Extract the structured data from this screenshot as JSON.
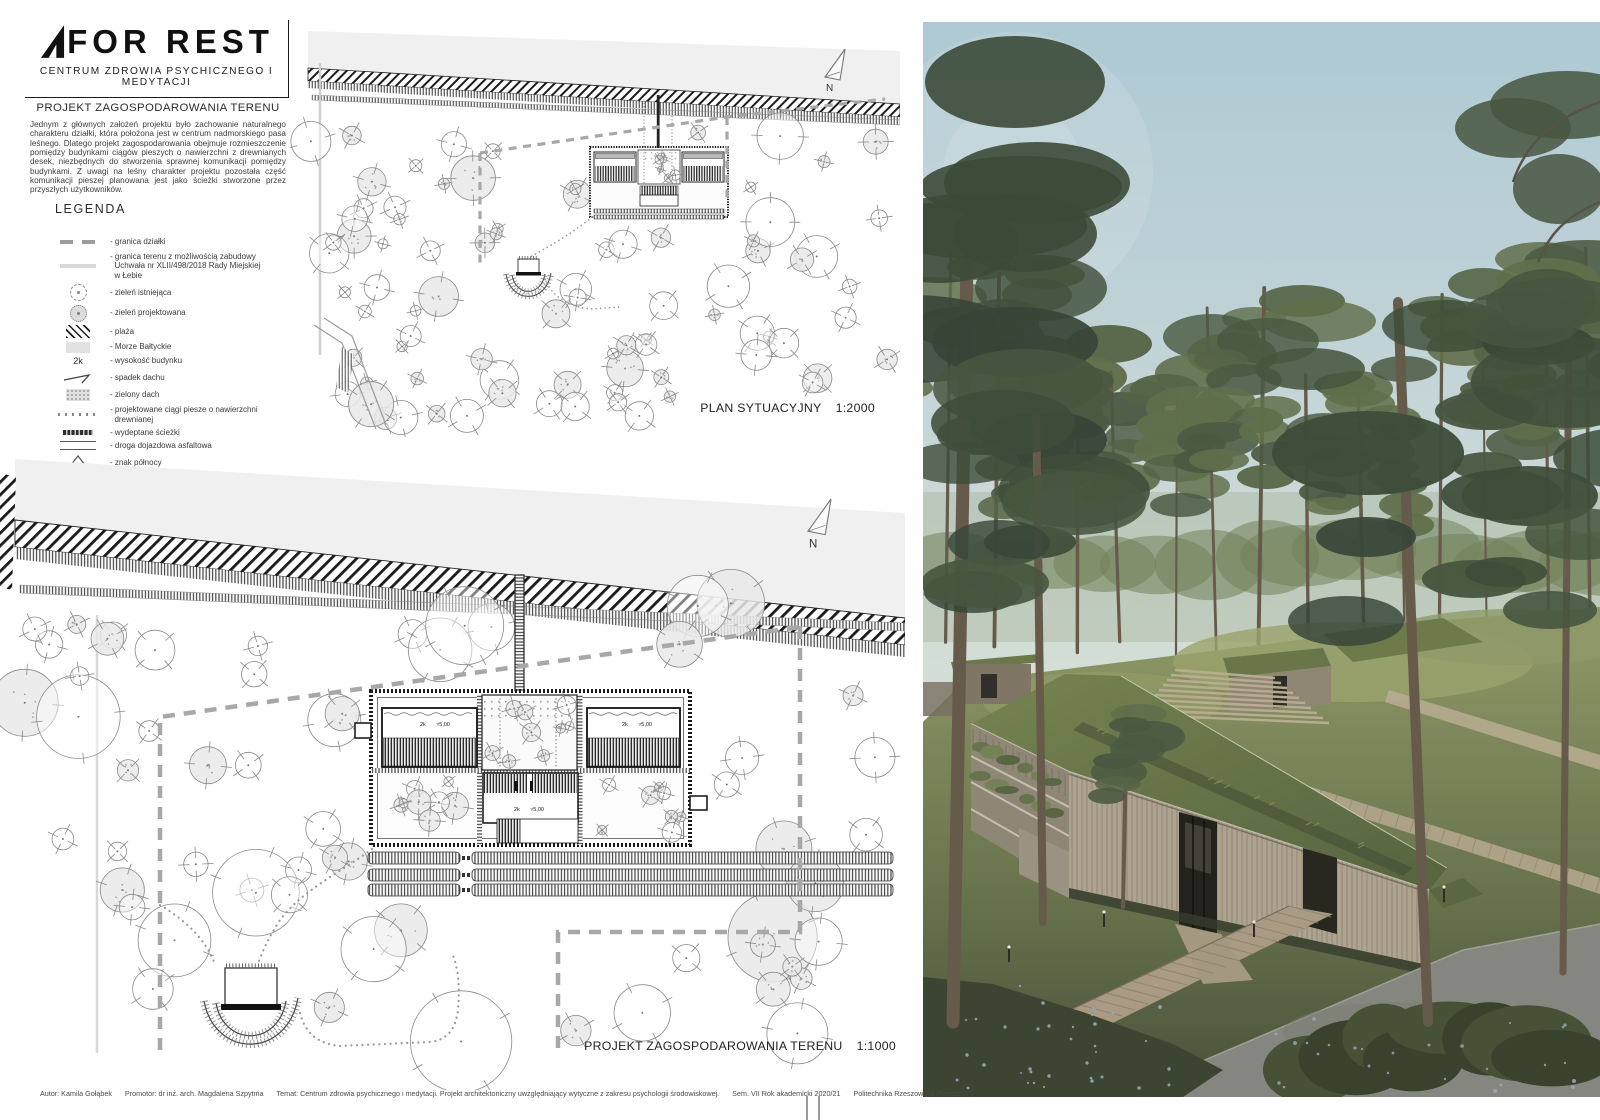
{
  "logo": {
    "title": "FOR REST",
    "subtitle": "CENTRUM ZDROWIA PSYCHICZNEGO I MEDYTACJI"
  },
  "intro": {
    "heading": "PROJEKT ZAGOSPODAROWANIA TERENU",
    "body": "Jednym z głównych założeń projektu było zachowanie naturalnego charakteru działki, która położona jest w centrum nadmorskiego pasa leśnego. Dlatego projekt zagospodarowania obejmuje rozmieszczenie pomiędzy budynkami ciągów pieszych o nawierzchni z drewnianych desek, niezbędnych do stworzenia sprawnej komunikacji pomiędzy budynkami. Z uwagi na leśny charakter projektu pozostała część komunikacji pieszej planowana jest jako ścieżki stworzone przez przyszłych użytkowników."
  },
  "legend": {
    "heading": "LEGENDA",
    "items": [
      {
        "symbol": "boundary-dashes",
        "lines": [
          "- granica działki"
        ]
      },
      {
        "symbol": "boundary-line",
        "lines": [
          "- granica terenu z możliwością zabudowy",
          "  Uchwała nr XLII/498/2018 Rady Miejskiej",
          "  w Łebie"
        ]
      },
      {
        "symbol": "tree-existing",
        "lines": [
          "- zieleń istniejąca"
        ]
      },
      {
        "symbol": "tree-proposed",
        "lines": [
          "- zieleń projektowana"
        ]
      },
      {
        "symbol": "beach-hatch",
        "lines": [
          "- plaża"
        ]
      },
      {
        "symbol": "sea",
        "lines": [
          "- Morze Bałtyckie"
        ]
      },
      {
        "symbol": "height-text",
        "symbol_text": "2k",
        "lines": [
          "- wysokość budynku"
        ]
      },
      {
        "symbol": "roof-slope",
        "lines": [
          "- spadek dachu"
        ]
      },
      {
        "symbol": "green-roof",
        "lines": [
          "- zielony dach"
        ]
      },
      {
        "symbol": "dotted-path",
        "lines": [
          "- projektowane ciągi piesze o nawierzchni",
          "  drewnianej"
        ]
      },
      {
        "symbol": "trodden-path",
        "lines": [
          "- wydeptane ścieżki"
        ]
      },
      {
        "symbol": "asphalt-road",
        "lines": [
          "- droga dojazdowa asfaltowa"
        ]
      },
      {
        "symbol": "north-sign",
        "lines": [
          "- znak północy"
        ]
      }
    ]
  },
  "plans": {
    "site_plan": {
      "label": "PLAN SYTUACYJNY",
      "scale": "1:2000",
      "north": "N"
    },
    "master_plan": {
      "label": "PROJEKT ZAGOSPODAROWANIA TERENU",
      "scale": "1:1000",
      "north": "N"
    },
    "height_label": "2k",
    "level_label": "5,00"
  },
  "footer": {
    "segments": [
      "Autor: Kamila Gołąbek",
      "Promotor: dr inż. arch. Magdalena Szpytma",
      "Temat: Centrum zdrowia psychicznego i medytacji. Projekt architektoniczny uwzględniający wytyczne z zakresu psychologii środowiskowej.",
      "Sem. VII  Rok akademicki 2020/21",
      "Politechnika Rzeszowska  Plansza 2"
    ]
  },
  "colors": {
    "board_bg": "#ffffff",
    "plan_gray": "#f0f0f0",
    "line_dark": "#1b1b1b",
    "boundary_gray": "#a8a8a8",
    "sky": "#b7d2de",
    "forest_green": "#4e5c45",
    "roof_grass": "#6b7a4c",
    "wood": "#b6aa96",
    "concrete": "#8d8c86"
  }
}
